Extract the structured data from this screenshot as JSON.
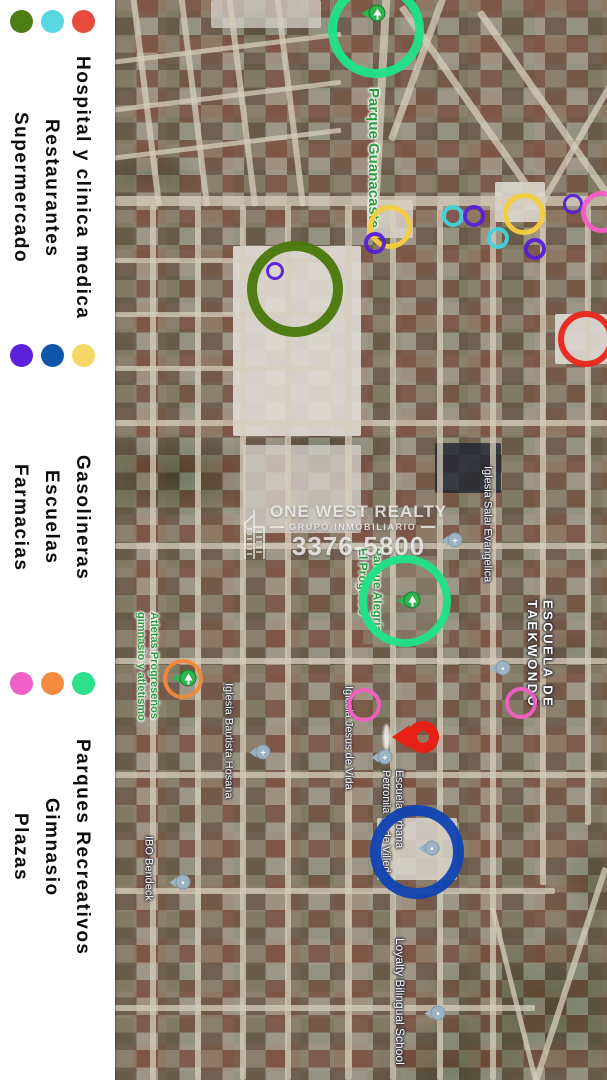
{
  "legend": {
    "groups": [
      {
        "items": [
          {
            "id": "hospital",
            "label": "Hospital y clinica medica",
            "color": "#e84a3c"
          },
          {
            "id": "restaurantes",
            "label": "Restaurantes",
            "color": "#57d7e2"
          },
          {
            "id": "supermercado",
            "label": "Supermercado",
            "color": "#4f7d15"
          }
        ]
      },
      {
        "items": [
          {
            "id": "gasolineras",
            "label": "Gasolineras",
            "color": "#f7d763"
          },
          {
            "id": "escuelas",
            "label": "Escuelas",
            "color": "#1155ab"
          },
          {
            "id": "farmacias",
            "label": "Farmacias",
            "color": "#5b21dd"
          }
        ]
      },
      {
        "items": [
          {
            "id": "parques",
            "label": "Parques Recreativos",
            "color": "#2ee08c"
          },
          {
            "id": "gimnasio",
            "label": "Gimnasio",
            "color": "#f58b41"
          },
          {
            "id": "plazas",
            "label": "Plazas",
            "color": "#f160c6"
          }
        ]
      }
    ]
  },
  "watermark": {
    "line1": "ONE WEST REALTY",
    "line2": "GRUPO INMOBILIARIO",
    "line3": "3376-5800"
  },
  "map": {
    "palette": {
      "parque": "#1fe287",
      "gasolinera": "#f5cd3d",
      "farmacia": "#5a1fd6",
      "restaurante": "#43d2de",
      "plaza": "#f35fc4",
      "supermercado": "#497a0c",
      "hospital": "#e8261b",
      "escuela": "#1244b2",
      "gimnasio": "#f0883a"
    },
    "circles": [
      {
        "category": "parque",
        "cx": 261,
        "cy": 30,
        "r": 48,
        "stroke": 9
      },
      {
        "category": "gasolinera",
        "cx": 275,
        "cy": 227,
        "r": 22,
        "stroke": 5
      },
      {
        "category": "farmacia",
        "cx": 260,
        "cy": 243,
        "r": 11,
        "stroke": 4
      },
      {
        "category": "restaurante",
        "cx": 338,
        "cy": 216,
        "r": 11,
        "stroke": 4
      },
      {
        "category": "farmacia",
        "cx": 359,
        "cy": 216,
        "r": 11,
        "stroke": 4
      },
      {
        "category": "restaurante",
        "cx": 383,
        "cy": 238,
        "r": 11,
        "stroke": 4
      },
      {
        "category": "farmacia",
        "cx": 420,
        "cy": 249,
        "r": 11,
        "stroke": 4
      },
      {
        "category": "gasolinera",
        "cx": 409,
        "cy": 214,
        "r": 21,
        "stroke": 5
      },
      {
        "category": "farmacia",
        "cx": 458,
        "cy": 204,
        "r": 10,
        "stroke": 3
      },
      {
        "category": "plaza",
        "cx": 487,
        "cy": 212,
        "r": 21,
        "stroke": 5
      },
      {
        "category": "supermercado",
        "cx": 180,
        "cy": 289,
        "r": 48,
        "stroke": 10
      },
      {
        "category": "farmacia",
        "cx": 160,
        "cy": 271,
        "r": 9,
        "stroke": 3
      },
      {
        "category": "hospital",
        "cx": 471,
        "cy": 339,
        "r": 28,
        "stroke": 6
      },
      {
        "category": "parque",
        "cx": 290,
        "cy": 601,
        "r": 46,
        "stroke": 8
      },
      {
        "category": "plaza",
        "cx": 249,
        "cy": 705,
        "r": 17,
        "stroke": 4
      },
      {
        "category": "plaza",
        "cx": 406,
        "cy": 703,
        "r": 16,
        "stroke": 4
      },
      {
        "category": "gimnasio",
        "cx": 68,
        "cy": 679,
        "r": 20,
        "stroke": 4
      },
      {
        "category": "escuela",
        "cx": 302,
        "cy": 852,
        "r": 47,
        "stroke": 11
      }
    ],
    "labels": [
      {
        "lines": [
          "Parque Guanacaste"
        ],
        "color": "green",
        "x": 258,
        "y": 88,
        "h": 215,
        "size": 15
      },
      {
        "lines": [
          "Iglesia Salai Evangelica"
        ],
        "color": "white",
        "x": 372,
        "y": 466,
        "h": 145,
        "size": 11
      },
      {
        "lines": [
          "ESCUELA DE",
          "TAEKWONDO"
        ],
        "color": "white",
        "caps": true,
        "x": 425,
        "y": 600,
        "h": 130,
        "size": 13
      },
      {
        "lines": [
          "Parque Alegría",
          "El Progreso"
        ],
        "color": "green",
        "x": 255,
        "y": 548,
        "h": 110,
        "size": 12
      },
      {
        "lines": [
          "Iglesia Jesus de Vida"
        ],
        "color": "white",
        "x": 233,
        "y": 686,
        "h": 130,
        "size": 11
      },
      {
        "lines": [
          "Escuela Urbana",
          "Petronila C. de Villeda"
        ],
        "color": "white",
        "x": 277,
        "y": 770,
        "h": 145,
        "size": 11
      },
      {
        "lines": [
          "Atletas Progreseños",
          "gimnasio y atletismo"
        ],
        "color": "green",
        "x": 32,
        "y": 612,
        "h": 128,
        "size": 11
      },
      {
        "lines": [
          "Iglesia Bautista Hosana"
        ],
        "color": "white",
        "x": 113,
        "y": 683,
        "h": 140,
        "size": 11
      },
      {
        "lines": [
          "IBO Bendeck"
        ],
        "color": "white",
        "x": 33,
        "y": 836,
        "h": 85,
        "size": 11
      },
      {
        "lines": [
          "Loyalty Bilingual School"
        ],
        "color": "white",
        "x": 285,
        "y": 938,
        "h": 142,
        "size": 12
      }
    ],
    "markers": [
      {
        "type": "park",
        "x": 262,
        "y": 13
      },
      {
        "type": "park",
        "x": 297,
        "y": 600
      },
      {
        "type": "park",
        "x": 73,
        "y": 678
      },
      {
        "type": "church",
        "x": 340,
        "y": 540
      },
      {
        "type": "church",
        "x": 148,
        "y": 752
      },
      {
        "type": "church",
        "x": 270,
        "y": 757
      },
      {
        "type": "school",
        "x": 68,
        "y": 882
      },
      {
        "type": "school",
        "x": 323,
        "y": 1013
      },
      {
        "type": "school",
        "x": 317,
        "y": 848
      },
      {
        "type": "school",
        "x": 388,
        "y": 668
      },
      {
        "type": "red",
        "x": 308,
        "y": 737
      }
    ]
  }
}
